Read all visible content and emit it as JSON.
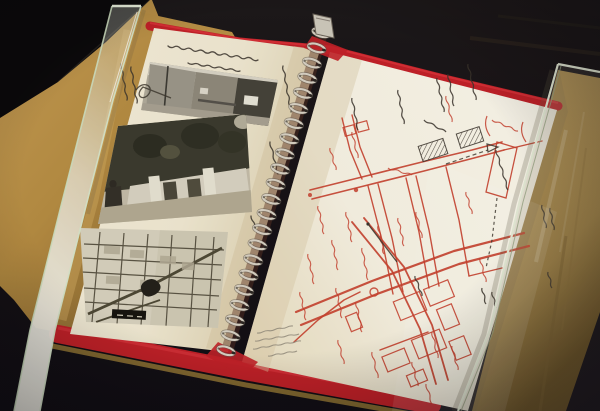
{
  "scene": {
    "title": "Open spiral-bound survey scrapbook displayed in a museum case",
    "description": "Photograph of an open red-covered wire-bound scrapbook lying in a dark display case under glass. The left cream page holds three black-and-white photographs (a shop street, a white gate among trees, a printed city map clipping) with handwritten Japanese captions. The right page carries a hand-drawn street map in red ink with black ink annotations and a pencil note. Handwriting is not legible at this resolution.",
    "transcription_note": "All handwriting is Japanese and too small/blurred to transcribe; the only partially legible fragment resembles a date ending the title line (7月1日)."
  },
  "display_case": {
    "background_hex": "#151015",
    "mat_board_hex": "#b68c42",
    "floor_right_hex": "#a0814a",
    "glass_edge_hex": "#dce8cf"
  },
  "album": {
    "cover_hex": "#c32028",
    "gold_trim_hex": "#8f7233",
    "left_paper_hex": "#f1e9d3",
    "right_paper_hex": "#f8f3e4"
  },
  "binding": {
    "coil_count": 22,
    "top": [
      322,
      33
    ],
    "bottom": [
      227,
      351
    ],
    "silver_hex": "#d9d2c5",
    "shadow_hex": "#5d564e",
    "hole_hex": "#2b2522"
  },
  "left_page": {
    "ink_hex": "#3a332b",
    "title_lines": 2,
    "caption_style": "vertical handwritten columns beside photos",
    "strokes": [
      [
        168,
        46,
        258,
        60,
        2.2
      ],
      [
        188,
        63,
        240,
        71,
        1.6
      ],
      [
        121,
        64,
        127,
        100,
        1.4
      ],
      [
        131,
        67,
        137,
        103,
        1.4
      ],
      [
        283,
        66,
        291,
        112,
        1.5
      ],
      [
        270,
        142,
        278,
        174,
        1.4
      ],
      [
        251,
        216,
        257,
        232,
        1.2
      ]
    ],
    "arrow_d": "M136,90 c8,-11 19,-3 12,5 c-5,6 -14,1 -5,-8 l28,11"
  },
  "right_page_map": {
    "colors": {
      "road": "#c8402e",
      "black": "#3a332b",
      "pencil": "#8d8678"
    },
    "roads": [
      {
        "pts": [
          [
            310,
            190
          ],
          [
            362,
            177
          ],
          [
            422,
            162
          ],
          [
            472,
            150
          ],
          [
            502,
            142
          ]
        ],
        "w": 1.6
      },
      {
        "pts": [
          [
            312,
            199
          ],
          [
            364,
            186
          ],
          [
            424,
            171
          ],
          [
            474,
            158
          ],
          [
            504,
            150
          ]
        ],
        "w": 1.6
      },
      {
        "pts": [
          [
            342,
            118
          ],
          [
            350,
            150
          ],
          [
            362,
            179
          ]
        ],
        "w": 1.4
      },
      {
        "pts": [
          [
            352,
            115
          ],
          [
            360,
            147
          ],
          [
            372,
            177
          ]
        ],
        "w": 1.4
      },
      {
        "pts": [
          [
            368,
            186
          ],
          [
            382,
            240
          ],
          [
            393,
            294
          ]
        ],
        "w": 1.4
      },
      {
        "pts": [
          [
            378,
            184
          ],
          [
            392,
            238
          ],
          [
            403,
            292
          ]
        ],
        "w": 1.4
      },
      {
        "pts": [
          [
            406,
            178
          ],
          [
            419,
            232
          ],
          [
            429,
            288
          ]
        ],
        "w": 1.4
      },
      {
        "pts": [
          [
            416,
            176
          ],
          [
            429,
            230
          ],
          [
            439,
            286
          ]
        ],
        "w": 1.4
      },
      {
        "pts": [
          [
            446,
            167
          ],
          [
            459,
            220
          ],
          [
            469,
            276
          ]
        ],
        "w": 1.4
      },
      {
        "pts": [
          [
            296,
            312
          ],
          [
            372,
            281
          ],
          [
            454,
            251
          ],
          [
            524,
            233
          ]
        ],
        "w": 2.2
      },
      {
        "pts": [
          [
            301,
            325
          ],
          [
            377,
            294
          ],
          [
            459,
            264
          ],
          [
            529,
            246
          ]
        ],
        "w": 2.2
      },
      {
        "pts": [
          [
            352,
            222
          ],
          [
            392,
            271
          ],
          [
            420,
            329
          ],
          [
            436,
            384
          ]
        ],
        "w": 1.8
      },
      {
        "pts": [
          [
            364,
            218
          ],
          [
            404,
            267
          ],
          [
            432,
            325
          ],
          [
            448,
            380
          ]
        ],
        "w": 1.8
      },
      {
        "pts": [
          [
            294,
            342
          ],
          [
            318,
            320
          ],
          [
            344,
            300
          ],
          [
            360,
            292
          ]
        ],
        "w": 1.5
      },
      {
        "pts": [
          [
            469,
            276
          ],
          [
            502,
            268
          ]
        ],
        "w": 1.4
      },
      {
        "pts": [
          [
            380,
            350
          ],
          [
            428,
            332
          ]
        ],
        "w": 1.4
      },
      {
        "pts": [
          [
            504,
            150
          ],
          [
            542,
            141
          ]
        ],
        "w": 1.4
      }
    ],
    "blocks": [
      [
        396,
        296,
        28,
        20,
        -22
      ],
      [
        426,
        284,
        26,
        18,
        -22
      ],
      [
        414,
        334,
        30,
        20,
        -22
      ],
      [
        384,
        352,
        24,
        16,
        -22
      ],
      [
        440,
        306,
        16,
        22,
        -22
      ],
      [
        452,
        338,
        16,
        20,
        -22
      ],
      [
        408,
        372,
        18,
        12,
        -22
      ],
      [
        348,
        314,
        12,
        16,
        -22
      ],
      [
        344,
        126,
        11,
        9,
        -15
      ],
      [
        357,
        122,
        11,
        9,
        -15
      ]
    ],
    "hatched": [
      [
        420,
        142,
        26,
        16,
        -18
      ],
      [
        458,
        130,
        24,
        15,
        -18
      ]
    ],
    "tall_box": [
      [
        497,
        142
      ],
      [
        517,
        148
      ],
      [
        506,
        198
      ],
      [
        486,
        192
      ]
    ],
    "parens": [
      [
        487,
        116,
        490,
        136
      ],
      [
        523,
        122,
        526,
        142
      ]
    ],
    "red_notes": [
      [
        318,
        206,
        324,
        234
      ],
      [
        332,
        240,
        338,
        270
      ],
      [
        346,
        212,
        352,
        242
      ],
      [
        308,
        254,
        314,
        284
      ],
      [
        362,
        248,
        368,
        280
      ],
      [
        378,
        226,
        384,
        254
      ],
      [
        398,
        218,
        404,
        246
      ],
      [
        300,
        292,
        306,
        320
      ],
      [
        336,
        288,
        342,
        318
      ],
      [
        356,
        302,
        362,
        332
      ],
      [
        416,
        212,
        422,
        238
      ],
      [
        466,
        192,
        472,
        214
      ],
      [
        480,
        258,
        486,
        282
      ],
      [
        432,
        332,
        438,
        358
      ],
      [
        452,
        346,
        458,
        370
      ],
      [
        412,
        362,
        418,
        386
      ],
      [
        372,
        352,
        378,
        378
      ],
      [
        338,
        340,
        344,
        364
      ],
      [
        446,
        96,
        452,
        122
      ],
      [
        352,
        132,
        358,
        158
      ],
      [
        330,
        148,
        336,
        170
      ],
      [
        426,
        384,
        432,
        404
      ],
      [
        388,
        168,
        412,
        175
      ],
      [
        492,
        120,
        518,
        131
      ]
    ],
    "black_notes": [
      [
        352,
        98,
        358,
        130
      ],
      [
        398,
        90,
        404,
        124
      ],
      [
        437,
        78,
        444,
        112
      ],
      [
        448,
        74,
        454,
        106
      ],
      [
        468,
        64,
        476,
        100
      ],
      [
        424,
        120,
        446,
        132
      ],
      [
        496,
        150,
        508,
        190
      ],
      [
        542,
        205,
        546,
        228
      ],
      [
        550,
        208,
        554,
        230
      ],
      [
        482,
        288,
        486,
        304
      ],
      [
        492,
        292,
        496,
        308
      ],
      [
        415,
        276,
        422,
        296
      ],
      [
        548,
        272,
        552,
        288
      ]
    ],
    "pencil_notes": [
      [
        257,
        333,
        293,
        326
      ],
      [
        255,
        341,
        299,
        334
      ],
      [
        253,
        349,
        301,
        341
      ],
      [
        268,
        356,
        297,
        351
      ]
    ],
    "dashed_routes": [
      {
        "pts": [
          [
            446,
            164
          ],
          [
            470,
            156
          ],
          [
            488,
            150
          ]
        ],
        "dash": "4 3"
      },
      {
        "pts": [
          [
            497,
            198
          ],
          [
            492,
            240
          ],
          [
            486,
            268
          ]
        ],
        "dash": "3 3"
      }
    ],
    "triangles": [
      [
        492,
        147
      ]
    ],
    "arrow_lines": [
      [
        368,
        224,
        397,
        262
      ]
    ],
    "circles_red": [
      [
        374,
        292,
        4
      ]
    ],
    "dots_red": [
      [
        356,
        190,
        2.2
      ],
      [
        310,
        195,
        2
      ]
    ]
  }
}
